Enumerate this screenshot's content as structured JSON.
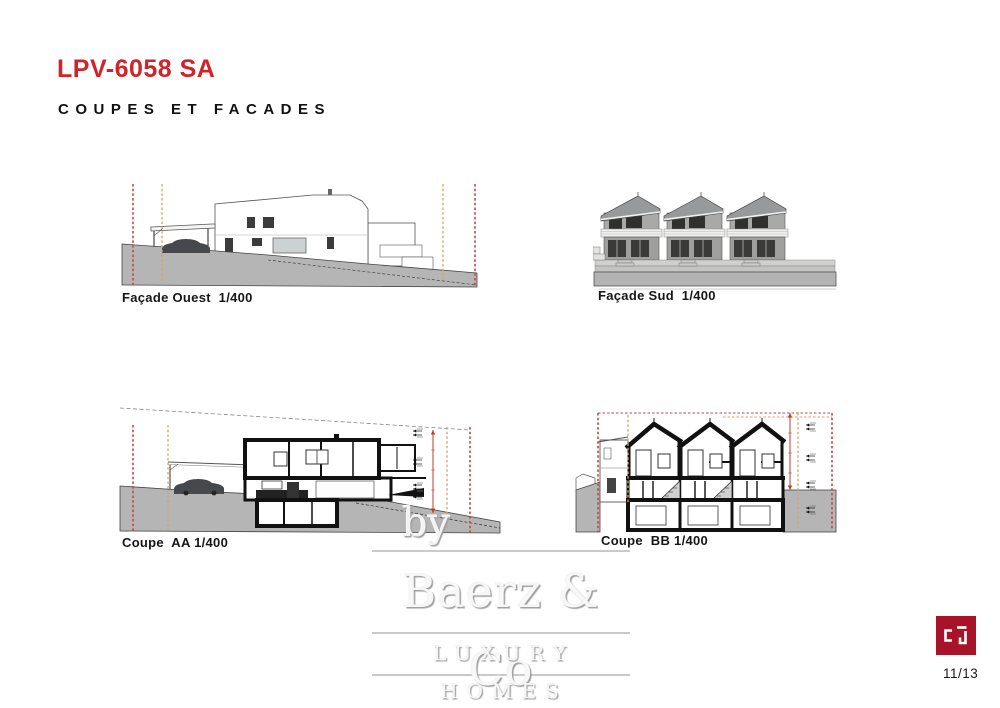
{
  "header": {
    "title": "LPV-6058 SA",
    "subtitle": "COUPES ET FACADES"
  },
  "drawings": [
    {
      "id": "facade-ouest",
      "label": "Façade Ouest  1/400"
    },
    {
      "id": "facade-sud",
      "label": "Façade Sud  1/400"
    },
    {
      "id": "coupe-aa",
      "label": "Coupe  AA 1/400"
    },
    {
      "id": "coupe-bb",
      "label": "Coupe  BB 1/400"
    }
  ],
  "watermark": {
    "by": "by",
    "name": "Baerz & Co",
    "tagline": "LUXURY HOMES"
  },
  "footer": {
    "page_number": "11/13",
    "logo": "cp-architect-logo"
  },
  "colors": {
    "accent_red": "#d0242b",
    "logo_red": "#a81329",
    "axis_dash_red": "#bf4a42",
    "axis_dash_orange": "#d8a363",
    "dimension_red": "#c0392b",
    "terrain_gray": "#b5b5b5"
  }
}
